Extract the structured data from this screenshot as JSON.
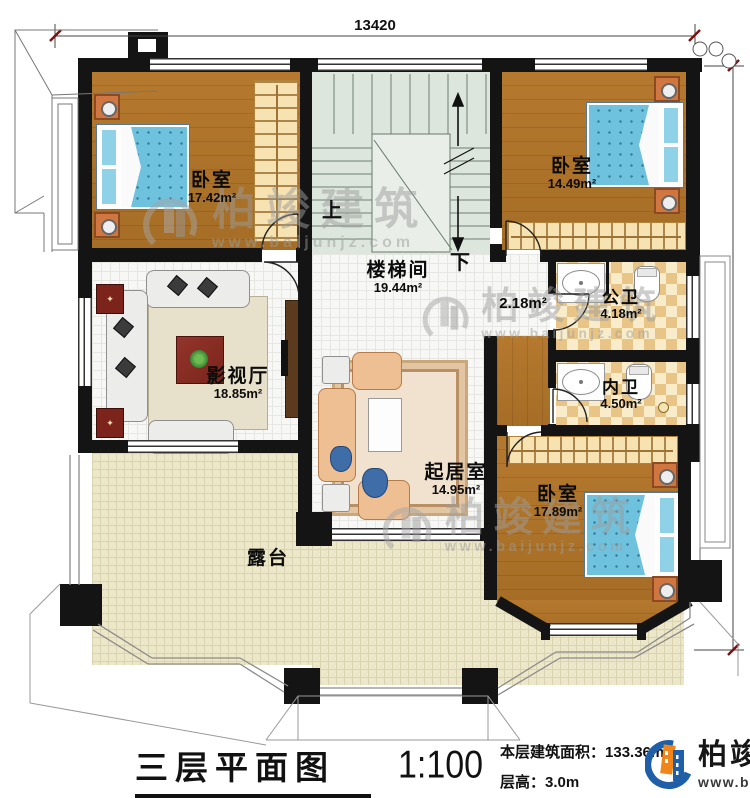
{
  "dimensions": {
    "top_width": "13420",
    "right_height": "13200"
  },
  "rooms": [
    {
      "name": "卧室",
      "area": "17.42m²"
    },
    {
      "name": "卧室",
      "area": "14.49m²"
    },
    {
      "name": "卧室",
      "area": "17.89m²"
    },
    {
      "name": "楼梯间",
      "area": "19.44m²"
    },
    {
      "name": "公卫",
      "area": "4.18m²"
    },
    {
      "name": "内卫",
      "area": "4.50m²"
    },
    {
      "name": "影视厅",
      "area": "18.85m²"
    },
    {
      "name": "起居室",
      "area": "14.95m²"
    },
    {
      "name": "露台",
      "area": ""
    },
    {
      "name": "",
      "area": "2.18m²"
    }
  ],
  "stairs": {
    "up_label": "上",
    "down_label": "下"
  },
  "watermark": {
    "name": "柏竣建筑",
    "url": "www.baijunjz.com"
  },
  "footer": {
    "plan_title": "三层平面图",
    "scale": "1:100",
    "area_label": "本层建筑面积：",
    "area_value": "133.36m²",
    "floor_height_label": "层高：",
    "floor_height_value": "3.0m"
  },
  "brand": {
    "name": "柏竣建筑",
    "url": "www.baijunjz.com"
  },
  "colors": {
    "wall": "#141414",
    "wood": "#ae752c",
    "bed": "#63b9d9",
    "stair": "#dde6dc",
    "terrace": "#ece7c9",
    "bath_tile": "#e8c487",
    "logo_blue": "#1f5fa8",
    "logo_orange": "#f08519"
  }
}
